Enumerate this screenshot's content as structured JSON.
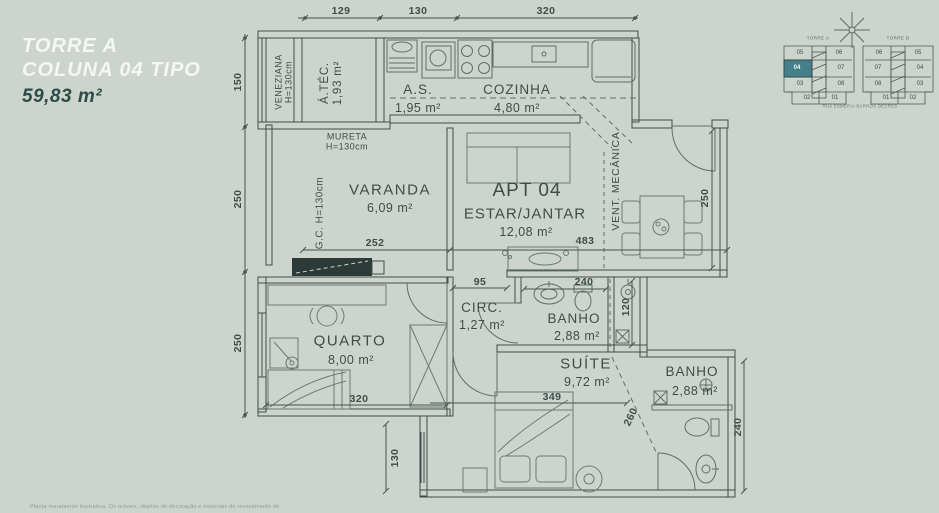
{
  "title": {
    "line1": "TORRE A",
    "line2": "COLUNA 04 TIPO",
    "area": "59,83 m²"
  },
  "plan": {
    "veneziana_label": "VENEZIANA",
    "veneziana_height": "H=130cm",
    "atec_name": "Á.TÉC.",
    "atec_area": "1,93 m²",
    "as_name": "A.S.",
    "as_area": "1,95 m²",
    "cozinha_name": "COZINHA",
    "cozinha_area": "4,80 m²",
    "mureta_label": "MURETA",
    "mureta_height": "H=130cm",
    "varanda_name": "VARANDA",
    "varanda_area": "6,09 m²",
    "gc_label": "G.C. H=130cm",
    "apt_number": "APT 04",
    "estar_name": "ESTAR/JANTAR",
    "estar_area": "12,08 m²",
    "vent_label": "VENT. MECÂNICA",
    "quarto_name": "QUARTO",
    "quarto_area": "8,00 m²",
    "circ_name": "CIRC.",
    "circ_area": "1,27 m²",
    "banho1_name": "BANHO",
    "banho1_area": "2,88 m²",
    "suite_name": "SUÍTE",
    "suite_area": "9,72 m²",
    "banho2_name": "BANHO",
    "banho2_area": "2,88 m²"
  },
  "dims": {
    "top_129": "129",
    "top_130": "130",
    "top_320": "320",
    "left_150": "150",
    "left_250a": "250",
    "left_250b": "250",
    "varanda_252": "252",
    "estar_483": "483",
    "hall_250": "250",
    "circ_95": "95",
    "banho1_240": "240",
    "shaft_120": "120",
    "quarto_320": "320",
    "suite_349": "349",
    "suite_130": "130",
    "suite_260": "260",
    "banho2_240": "240"
  },
  "minimap": {
    "torre_a": {
      "label": "TORRE A",
      "units": [
        [
          "05",
          "06"
        ],
        [
          "04",
          "07"
        ],
        [
          "03",
          "08"
        ],
        [
          "02",
          "01"
        ]
      ],
      "highlighted_unit": "04",
      "highlight_color": "#45808a"
    },
    "torre_b": {
      "label": "TORRE B",
      "units": [
        [
          "06",
          "05"
        ],
        [
          "07",
          "04"
        ],
        [
          "08",
          "03"
        ],
        [
          "01",
          "02"
        ]
      ]
    },
    "street": "RUA ESMÉRIA BARROS DECRES"
  },
  "disclaimer": "Planta meramente ilustrativa. Os móveis, objetos de decoração e materiais de revestimento de"
}
